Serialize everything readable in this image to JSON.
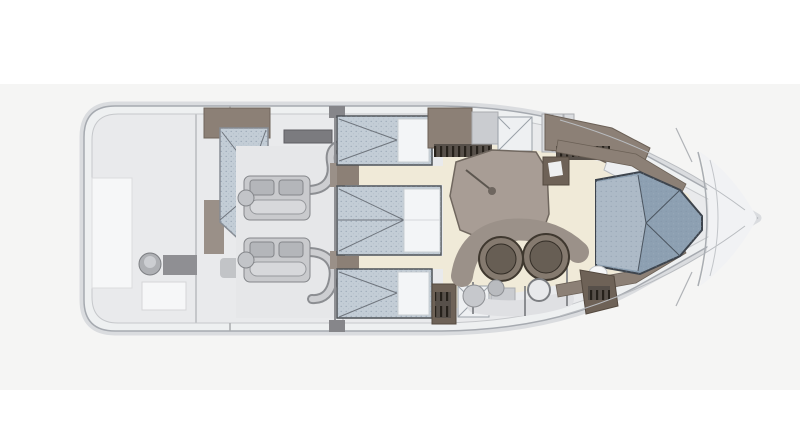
{
  "figure": {
    "type": "floorplan",
    "subject": "motor-yacht lower-deck plan, plan view",
    "orientation": "bow pointing right, stern at left",
    "notes": "scanned illustration, no visible text labels"
  },
  "palette": {
    "backdrop": "#f5f5f4",
    "hull_halo": "#dadcdf",
    "hull_fill": "#eef0f1",
    "hull_stroke": "#a6aab0",
    "deck_inner": "#e9eaec",
    "floor_cream": "#f0ead8",
    "wood": "#8c8076",
    "wood_mid": "#9a9088",
    "wood_dark": "#6e6257",
    "vent_dark": "#57504a",
    "table": "#a89d95",
    "counter": "#9b9189",
    "counter_light": "#dfe0e3",
    "bed_light": "#c3cdd6",
    "bed_dark": "#8da0b2",
    "pillow": "#f3f5f7",
    "pillow_bow": "#b0bdc9",
    "engine": "#c9cacd",
    "engine_dark": "#8c8e92",
    "engine_light": "#cdced1",
    "fixture": "#f6f7f8",
    "steel": "#aeb0b4",
    "tile_gray": "#caccd0",
    "shower_white": "#eef0f2",
    "foredeck": "#f1f2f4",
    "sink_outer": "#857a6f",
    "sink_inner": "#675e54",
    "line_dark": "#4e5257"
  },
  "elements": [
    {
      "name": "swim-platform-stern",
      "desc": "aft platform with round stool, lockers and hatch"
    },
    {
      "name": "crew-cabin",
      "desc": "aft cabin with angled berth, washbasin and cabinet"
    },
    {
      "name": "engine-room",
      "desc": "twin engines with S-shaped exhaust pipes"
    },
    {
      "name": "guest-berth-port",
      "desc": "single berth with white pillow"
    },
    {
      "name": "guest-berth-center",
      "desc": "double berth with two pillows"
    },
    {
      "name": "guest-berth-starboard",
      "desc": "single berth with white pillow"
    },
    {
      "name": "corridor",
      "desc": "cream companionway between cabins"
    },
    {
      "name": "head-shower-port",
      "desc": "bathroom tiles and shower pan"
    },
    {
      "name": "head-shower-starboard",
      "desc": "bathroom tiles and shower pan"
    },
    {
      "name": "companionway-steps",
      "desc": "three steps up to deck"
    },
    {
      "name": "dinette-table",
      "desc": "taupe polygon table with pedestal leg"
    },
    {
      "name": "galley",
      "desc": "counter with twin round sinks, stools, louvered cabinet"
    },
    {
      "name": "owner-cabin-bow",
      "desc": "V-berth pointing to the bow"
    },
    {
      "name": "foredeck",
      "desc": "plain bow deck beyond the cabin bulkhead"
    }
  ]
}
